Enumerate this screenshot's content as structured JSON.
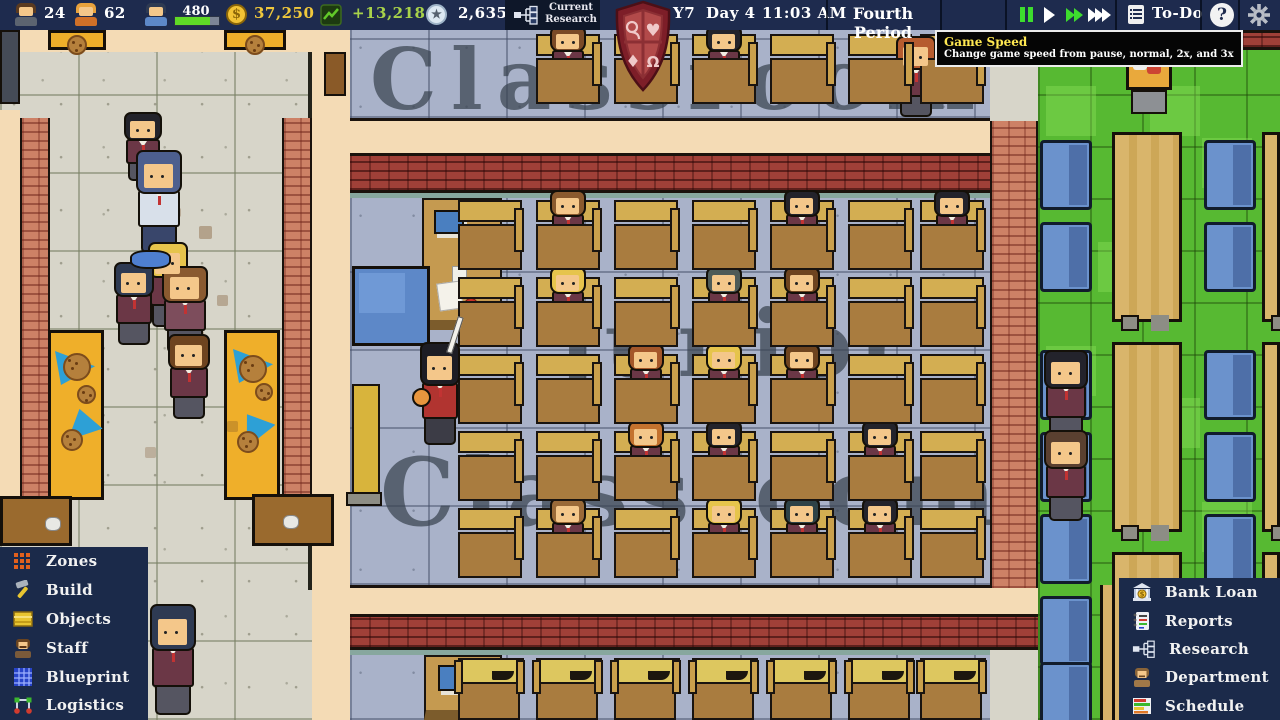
{
  "hud": {
    "teachers": "24",
    "workers": "62",
    "students": "480",
    "money": "37,250",
    "profit": "+13,218",
    "points": "2,635",
    "research_line1": "Current",
    "research_line2": "Research",
    "year": "Y7",
    "day": "Day 4",
    "time": "11:03 AM",
    "period": "Fourth Period",
    "todo": "To-Do",
    "help": "?"
  },
  "tooltip": {
    "title": "Game Speed",
    "body": "Change game speed from pause, normal, 2x, and 3x"
  },
  "left_menu": {
    "items": [
      {
        "label": "Zones",
        "icon": "zones-grid-icon"
      },
      {
        "label": "Build",
        "icon": "hammer-icon"
      },
      {
        "label": "Objects",
        "icon": "furniture-icon"
      },
      {
        "label": "Staff",
        "icon": "staff-person-icon"
      },
      {
        "label": "Blueprint",
        "icon": "blueprint-grid-icon"
      },
      {
        "label": "Logistics",
        "icon": "logistics-network-icon"
      }
    ]
  },
  "right_menu": {
    "items": [
      {
        "label": "Bank Loan",
        "icon": "bank-icon"
      },
      {
        "label": "Reports",
        "icon": "reports-icon"
      },
      {
        "label": "Research",
        "icon": "research-tree-icon"
      },
      {
        "label": "Department",
        "icon": "department-person-icon"
      },
      {
        "label": "Schedule",
        "icon": "schedule-icon"
      }
    ]
  },
  "colors": {
    "money_text": "#f0c83c",
    "profit_text": "#a8d24a",
    "tooltip_title": "#ffe851",
    "speed_active": "#3ddc2e",
    "panel_navy": "#1b2a4a"
  },
  "scene": {
    "watermark_top": "Classroom",
    "watermark_mid_line1": "Junior",
    "watermark_mid_line2": "Classroom",
    "desk_cols": [
      458,
      536,
      614,
      692,
      770,
      848,
      920
    ],
    "desk_rows": [
      200,
      277,
      354,
      431,
      508
    ],
    "seated": [
      {
        "r": 0,
        "c": 1,
        "hair": "#8a5a2e"
      },
      {
        "r": 0,
        "c": 4,
        "hair": "#23232b"
      },
      {
        "r": 0,
        "c": 6,
        "hair": "#23232b"
      },
      {
        "r": 1,
        "c": 1,
        "hair": "#e6c44c"
      },
      {
        "r": 1,
        "c": 3,
        "hair": "#4e5a57"
      },
      {
        "r": 1,
        "c": 4,
        "hair": "#6e441f"
      },
      {
        "r": 2,
        "c": 2,
        "hair": "#a4572a"
      },
      {
        "r": 2,
        "c": 3,
        "hair": "#e6c44c"
      },
      {
        "r": 2,
        "c": 4,
        "hair": "#6e441f"
      },
      {
        "r": 3,
        "c": 2,
        "hair": "#c4722e"
      },
      {
        "r": 3,
        "c": 3,
        "hair": "#23232b"
      },
      {
        "r": 3,
        "c": 5,
        "hair": "#23232b"
      },
      {
        "r": 4,
        "c": 1,
        "hair": "#9a6a38"
      },
      {
        "r": 4,
        "c": 3,
        "hair": "#e6c44c"
      },
      {
        "r": 4,
        "c": 4,
        "hair": "#2e4247"
      },
      {
        "r": 4,
        "c": 5,
        "hair": "#23232b"
      }
    ],
    "top_row_y": 34,
    "top_seated": [
      {
        "c": 1,
        "hair": "#7a4a26"
      },
      {
        "c": 2,
        "hair": "#6e441f"
      },
      {
        "c": 3,
        "hair": "#23232b"
      }
    ],
    "hall_people": [
      {
        "x": 124,
        "y": 112,
        "w": 38,
        "h": 70,
        "hair": "#23232b",
        "top": "#6b3746"
      },
      {
        "x": 136,
        "y": 150,
        "w": 46,
        "h": 104,
        "hair": "#4d5f8e",
        "top": "#d8e0ea",
        "skirt": "#39466b",
        "janitor": true
      },
      {
        "x": 148,
        "y": 242,
        "w": 40,
        "h": 86,
        "hair": "#e6c44c",
        "top": "#6b3746"
      },
      {
        "x": 114,
        "y": 262,
        "w": 40,
        "h": 84,
        "hair": "#2e3a52",
        "top": "#6b3746"
      },
      {
        "x": 162,
        "y": 266,
        "w": 46,
        "h": 88,
        "hair": "#8a5a30",
        "top": "#7d4d5c"
      },
      {
        "x": 168,
        "y": 334,
        "w": 42,
        "h": 86,
        "hair": "#6e441f",
        "top": "#6b3746"
      },
      {
        "x": 150,
        "y": 604,
        "w": 46,
        "h": 112,
        "hair": "#2e3a52",
        "top": "#6b3746"
      }
    ],
    "right_seated": [
      {
        "x": 1044,
        "y": 350,
        "w": 44,
        "h": 92,
        "hair": "#23232b",
        "top": "#6b3746"
      },
      {
        "x": 1044,
        "y": 430,
        "w": 44,
        "h": 92,
        "hair": "#5a4030",
        "top": "#6b3746"
      }
    ],
    "standing_red": {
      "x": 896,
      "y": 36,
      "w": 40,
      "h": 82,
      "hair": "#b65c2f",
      "top": "#6b3746"
    },
    "teacher": {
      "x": 420,
      "y": 342,
      "w": 40,
      "h": 104,
      "hair": "#1d1d24",
      "top": "#b13430",
      "skirt": "#3c3c46"
    }
  }
}
